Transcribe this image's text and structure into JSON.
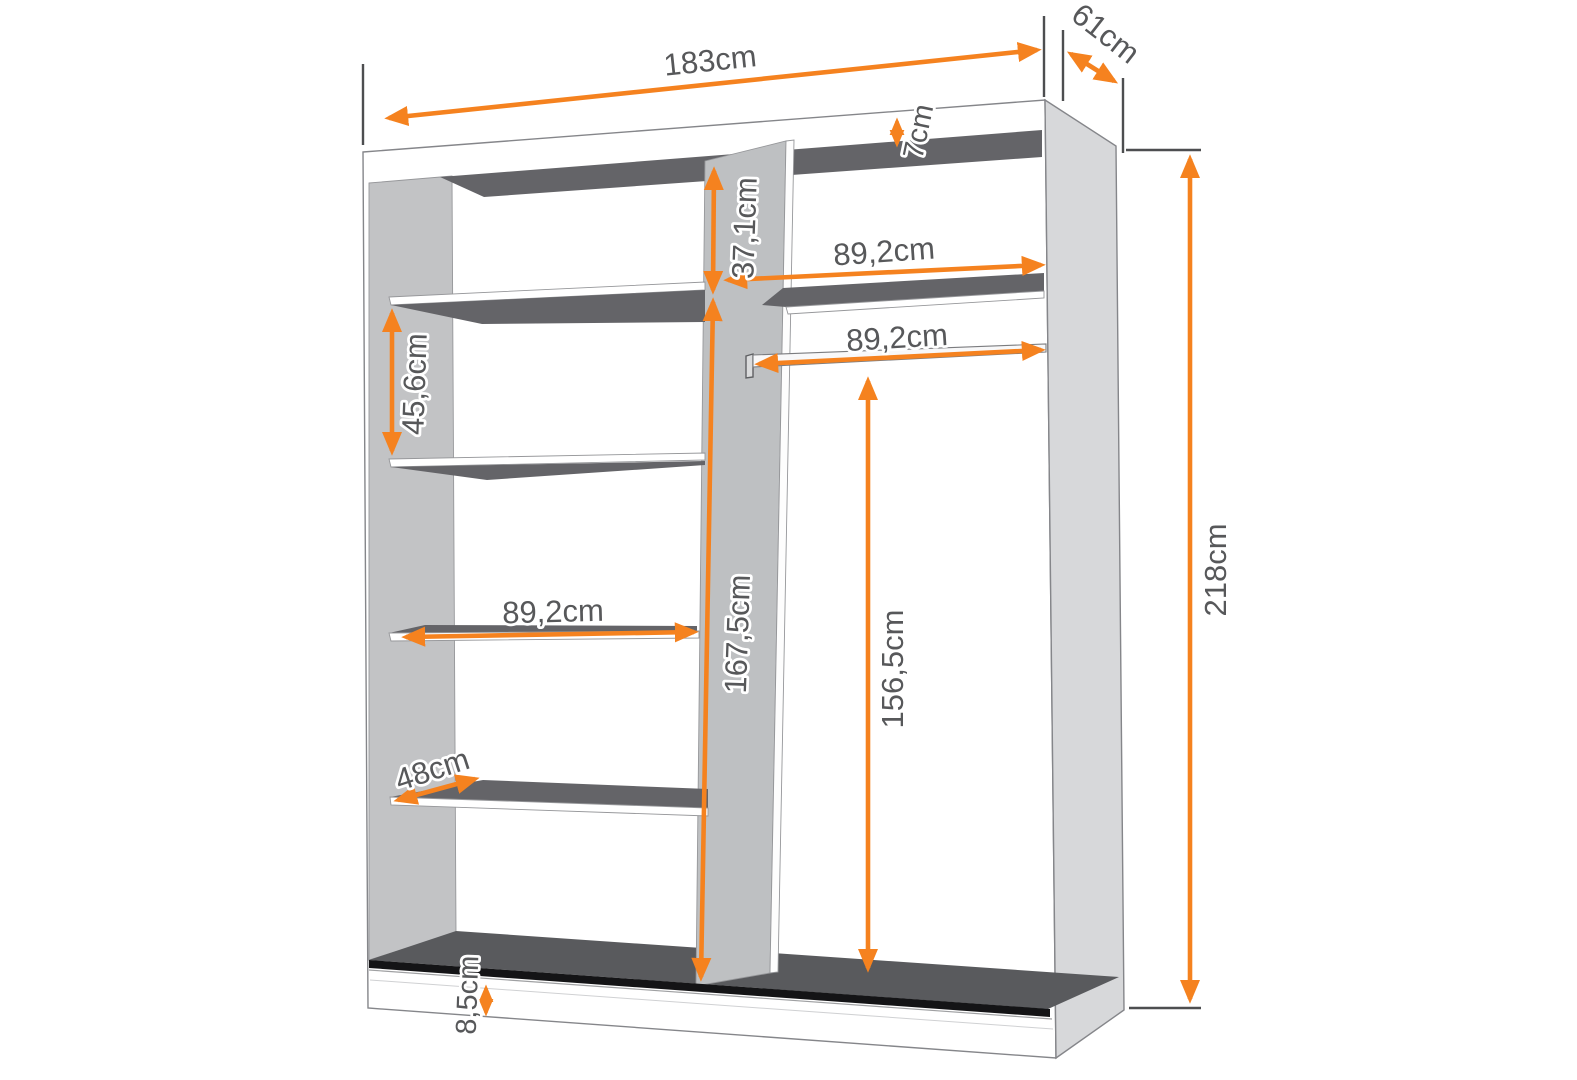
{
  "diagram": {
    "type": "furniture-dimension-drawing",
    "subject": "sliding-wardrobe-interior"
  },
  "colors": {
    "accent_orange": "#F5821F",
    "label_text": "#57585a",
    "panel_light_gray": "#d7d8da",
    "wall_gray": "#c2c3c5",
    "shadow_dark_gray": "#646468",
    "floor_dark": "#595a5d",
    "background": "#ffffff"
  },
  "dimensions": {
    "total_width": "183cm",
    "depth": "61cm",
    "total_height": "218cm",
    "top_panel_thickness": "7cm",
    "top_section_height": "37,1cm",
    "right_section_width": "89,2cm",
    "rail_length": "89,2cm",
    "left_section_height": "45,6cm",
    "left_section_width": "89,2cm",
    "divider_section_height": "167,5cm",
    "rail_height": "156,5cm",
    "shelf_depth": "48cm",
    "plinth_height": "8,5cm"
  }
}
